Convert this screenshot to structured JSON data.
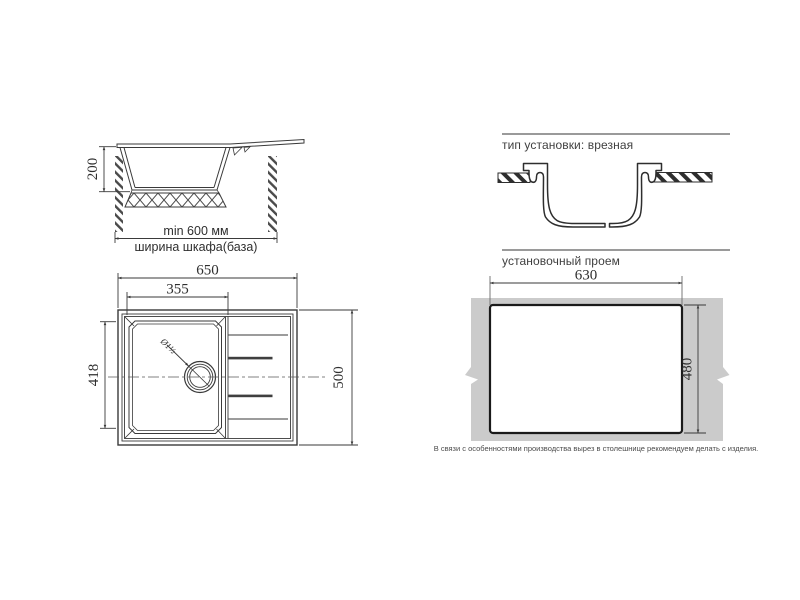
{
  "colors": {
    "line": "#3a3a3a",
    "divider": "#9a9a9a",
    "countertop": "#cbcbcb",
    "cutout_border": "#1a1a1a"
  },
  "side_view": {
    "dim_height": "200",
    "dim_min_width": "min 600 мм",
    "dim_caption": "ширина шкафа(база)"
  },
  "top_view": {
    "dim_total_width": "650",
    "dim_bowl_width": "355",
    "dim_bowl_depth": "418",
    "dim_total_depth": "500",
    "drain_label": "Ø1½"
  },
  "install_section": {
    "title": "тип установки: врезная"
  },
  "cutout_section": {
    "title": "установочный проем",
    "dim_width": "630",
    "dim_height": "480",
    "note": "В связи с особенностями производства вырез в столешнице рекомендуем делать с изделия."
  }
}
